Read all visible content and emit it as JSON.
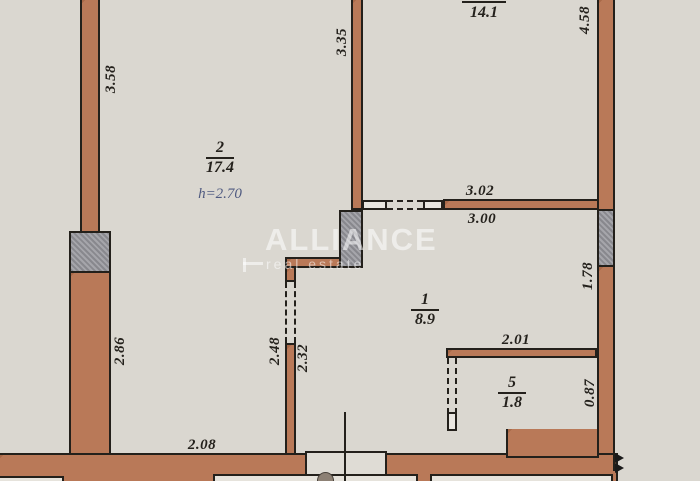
{
  "colors": {
    "bg": "#dad7d0",
    "wall": "#b5714e",
    "shaft": "#9b9ba1",
    "line": "#23201b",
    "note": "#4f5a80",
    "mark": "rgba(255,255,255,0.55)"
  },
  "watermark": {
    "brand": "ALLIANCE",
    "tagline": "real estate"
  },
  "rooms": {
    "room2": {
      "number": "2",
      "area": "17.4",
      "height": "h=2.70"
    },
    "room14": {
      "area": "14.1"
    },
    "room1": {
      "number": "1",
      "area": "8.9"
    },
    "room5": {
      "number": "5",
      "area": "1.8"
    }
  },
  "dims": {
    "d358": "3.58",
    "d335": "3.35",
    "d458": "4.58",
    "d302": "3.02",
    "d300": "3.00",
    "d178": "1.78",
    "d286": "2.86",
    "d248": "2.48",
    "d232": "2.32",
    "d201": "2.01",
    "d087": "0.87",
    "d208": "2.08"
  }
}
